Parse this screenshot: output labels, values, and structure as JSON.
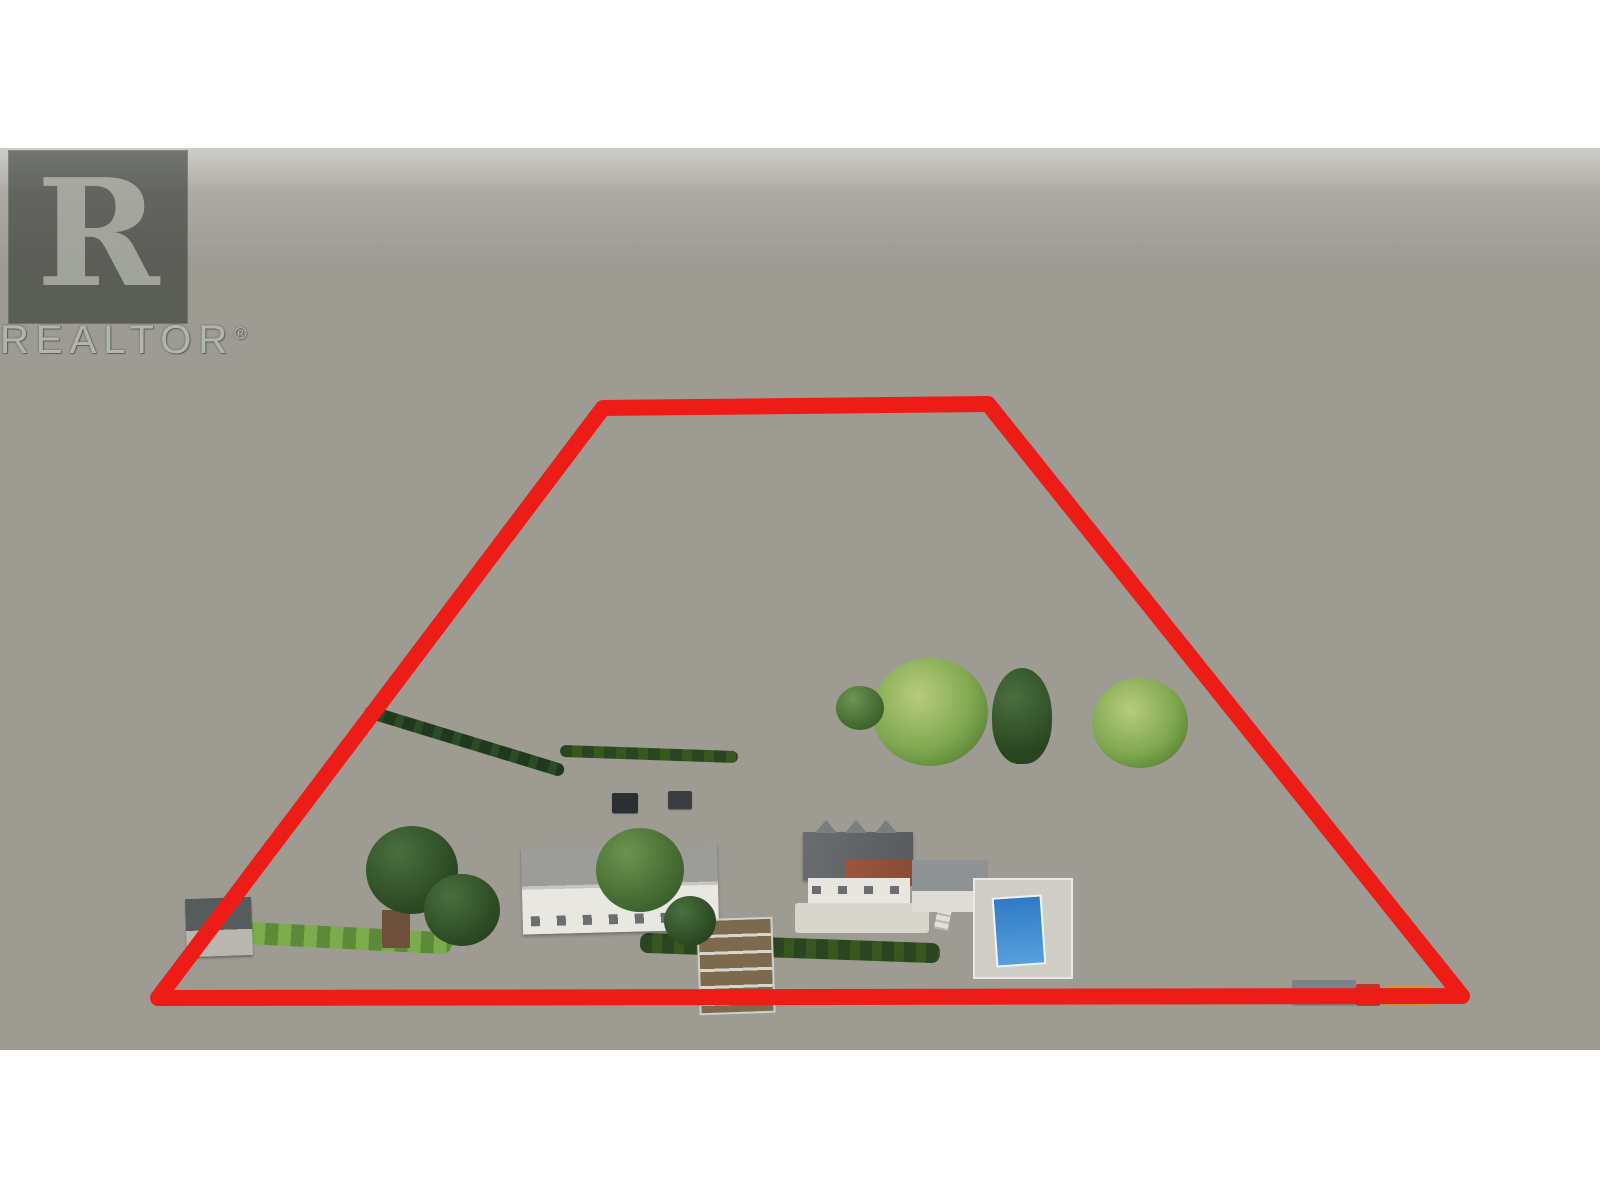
{
  "watermark": {
    "letter": "R",
    "brand": "REALTOR",
    "reg": "®"
  },
  "boundary": {
    "points": "603,260 988,256 1462,848 158,850",
    "color": "#ed1c16",
    "stroke_width": "16"
  },
  "palette": {
    "sky_band": "#ffffff",
    "distant_haze": "#c3cfc9",
    "forest": "#3a5838",
    "orchard_dark": "#2e4c28",
    "vineyard_row_green": "#4f8a38",
    "vineyard_soil": "#b0a276",
    "lawn": "#7ba34f",
    "gravel_road": "#b5b1a4",
    "dry_field": "#c3af73",
    "pool_blue": "#2f7ac6",
    "roof_gray": "#6a6d70",
    "roof_red_brown": "#96523c",
    "hedge_dark": "#2a451f",
    "boundary_red": "#ed1c16"
  },
  "scene": {
    "type": "aerial-drone-photo",
    "subject": "rural farm property with vineyard rows, central access road, house, pool and equipment yard outlined in red",
    "elements": [
      "distant-town",
      "forest-hillside",
      "rural-houses",
      "vineyard-left-block",
      "vineyard-right-block",
      "center-farm-road",
      "equipment-yard",
      "willow-trees",
      "main-house",
      "workshop-building",
      "swimming-pool",
      "garden-terraces",
      "lawn",
      "orchards",
      "dry-field",
      "property-boundary",
      "realtor-watermark"
    ]
  }
}
